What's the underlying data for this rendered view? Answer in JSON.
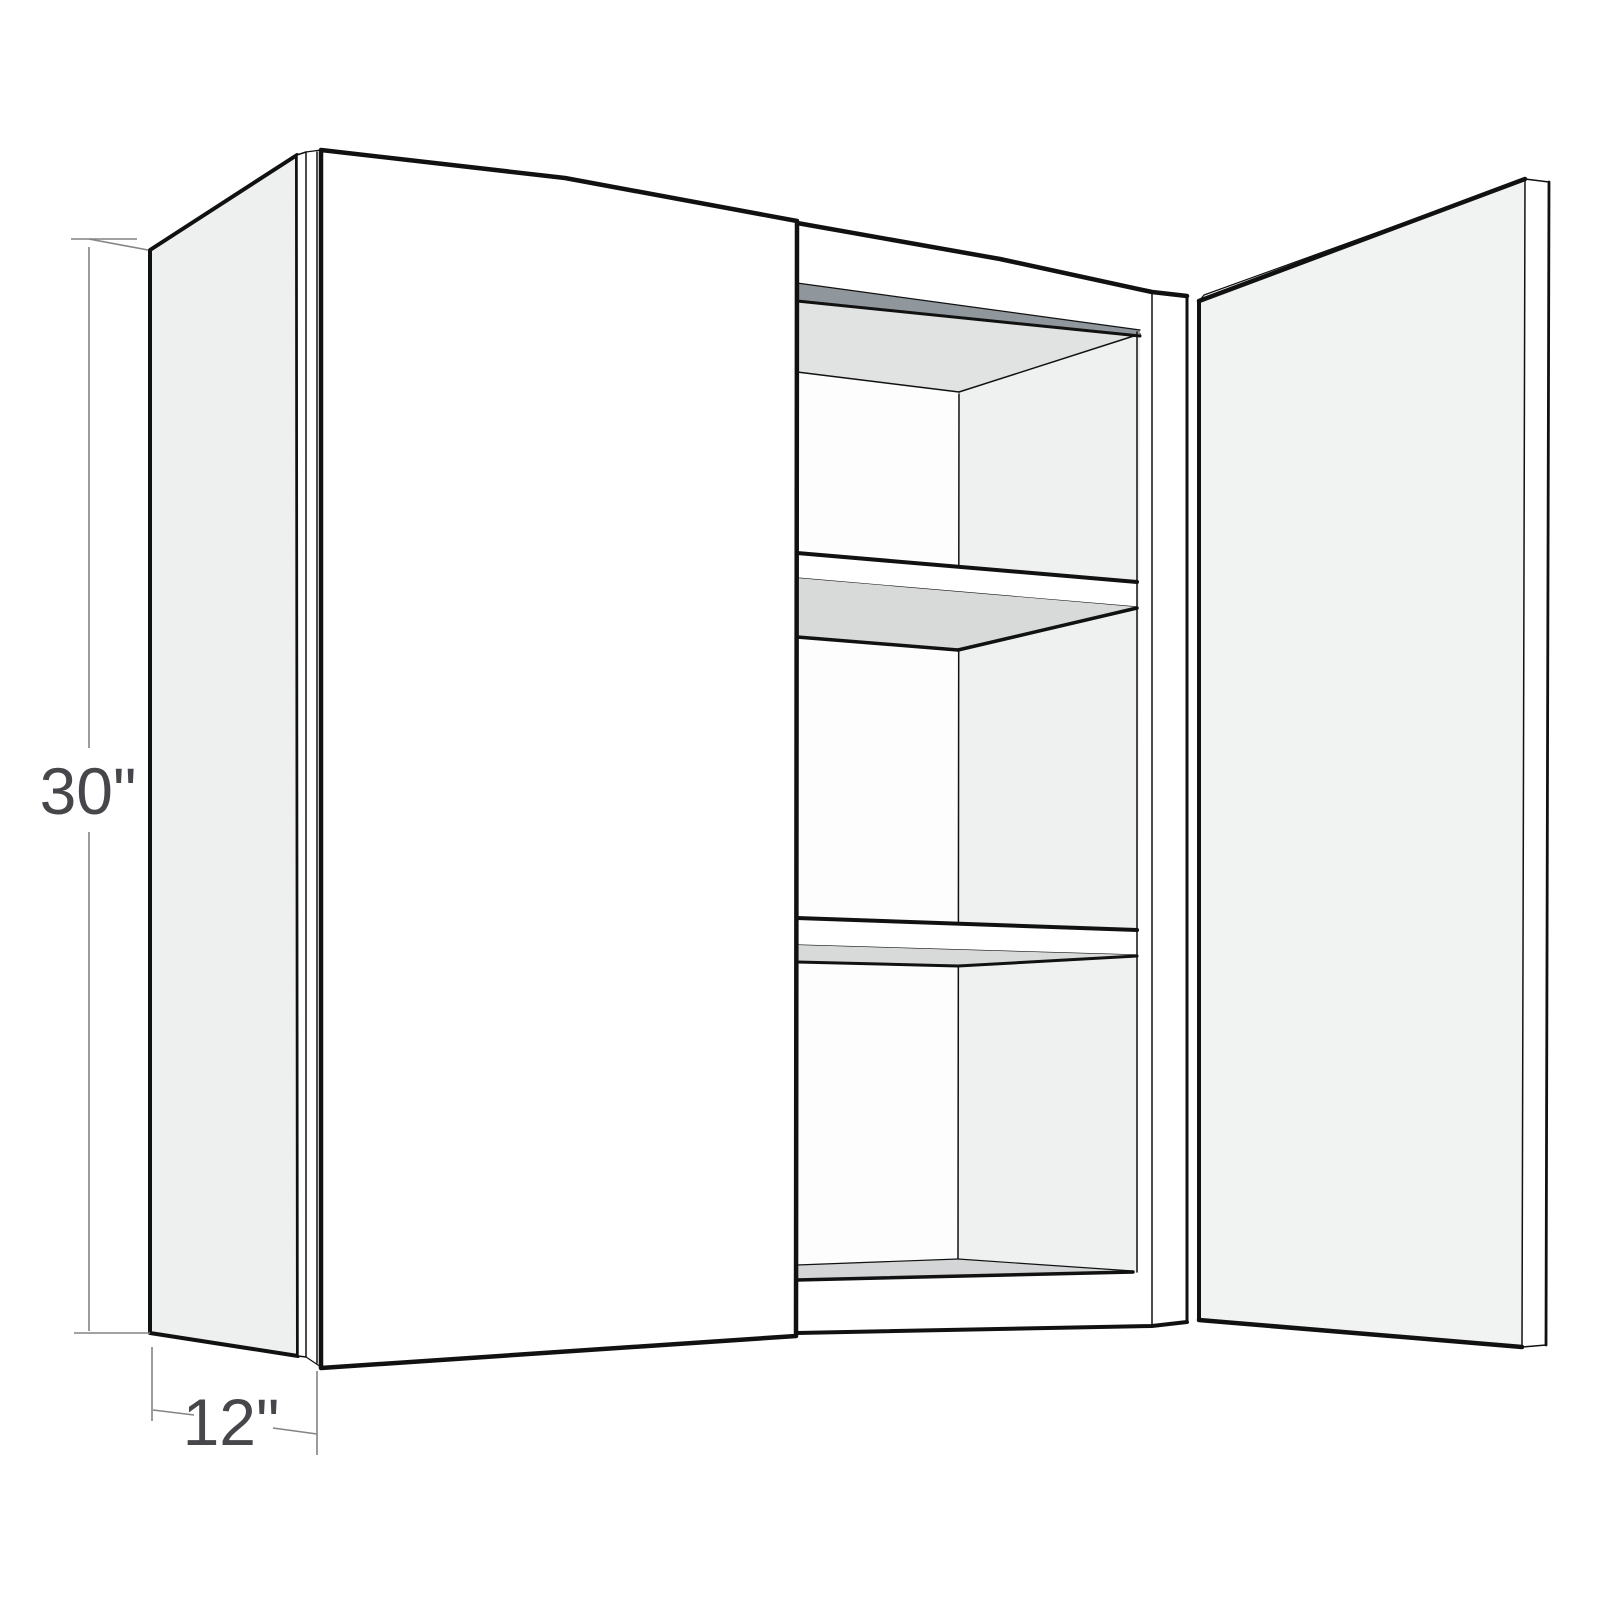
{
  "figure": {
    "description": "Isometric product line drawing of a two-door wall cabinet; left door closed, right door swung open revealing two interior shelves"
  },
  "dimensions": {
    "height": {
      "label": "30\""
    },
    "depth": {
      "label": "12\""
    }
  },
  "colors": {
    "outline": "#111111",
    "door_face": "#ffffff",
    "side_panel": "#eef0f0",
    "open_door_face": "#f1f2f2",
    "interior_wall": "#eff0f0",
    "back_wall": "#fdfdfd",
    "ceiling": "#e1e2e2",
    "shelf_underside": "#d8dada",
    "floor_top": "#d3d5d6",
    "top_rail_shadow": "#90979c",
    "dimension_line": "#848484",
    "dimension_text": "#47474b"
  }
}
